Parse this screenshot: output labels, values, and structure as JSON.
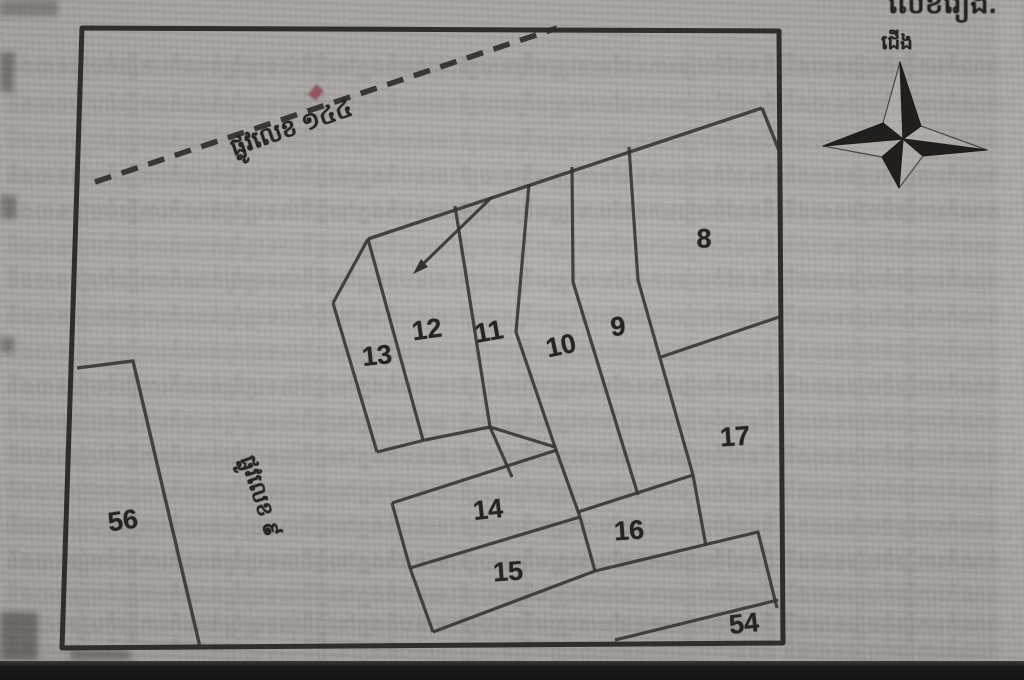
{
  "figure": {
    "description_labels": {
      "corner_fragment": "លេខរៀង.",
      "north": "ជើង"
    },
    "colors": {
      "paper": "#a9a6a2",
      "ink": "#2f2e2a",
      "interior_line": "#35322d",
      "label_ink": "#26241f",
      "bleed_default": "#6e6a64",
      "bleed_warm": "#7a6055",
      "photo_band": "#191917",
      "artifact_red": "#8c3e4e"
    }
  },
  "roads": [
    {
      "name": "road-144",
      "label": "ផ្លូវលេខ ១៤៤",
      "x": 292,
      "y": 130,
      "rotation": -19
    },
    {
      "name": "road-9",
      "label": "ផ្លូវលេខ ៩",
      "x": 258,
      "y": 497,
      "rotation": 72
    }
  ],
  "compass": {
    "label": "ជើង",
    "label_x": 897,
    "label_y": 44,
    "center": [
      903,
      139
    ]
  },
  "parcels": [
    {
      "number": "8",
      "x": 704,
      "y": 239,
      "rotation": 0
    },
    {
      "number": "9",
      "x": 618,
      "y": 327,
      "rotation": -5
    },
    {
      "number": "10",
      "x": 561,
      "y": 346,
      "rotation": -12
    },
    {
      "number": "11",
      "x": 489,
      "y": 332,
      "rotation": -10
    },
    {
      "number": "12",
      "x": 427,
      "y": 330,
      "rotation": -8
    },
    {
      "number": "13",
      "x": 377,
      "y": 356,
      "rotation": -6
    },
    {
      "number": "14",
      "x": 488,
      "y": 510,
      "rotation": -6
    },
    {
      "number": "15",
      "x": 508,
      "y": 572,
      "rotation": -4
    },
    {
      "number": "16",
      "x": 629,
      "y": 531,
      "rotation": -4
    },
    {
      "number": "17",
      "x": 735,
      "y": 437,
      "rotation": -4
    },
    {
      "number": "54",
      "x": 744,
      "y": 624,
      "rotation": -6
    },
    {
      "number": "56",
      "x": 123,
      "y": 521,
      "rotation": -8
    }
  ],
  "geometry": {
    "border": [
      [
        82,
        28
      ],
      [
        779,
        31
      ],
      [
        783,
        643
      ],
      [
        62,
        648
      ]
    ],
    "dashed_road": [
      [
        95,
        182
      ],
      [
        557,
        28
      ]
    ],
    "lines": [
      {
        "name": "parcel56-boundary",
        "w": 3.4,
        "pts": [
          [
            77,
            368
          ],
          [
            133,
            361
          ],
          [
            200,
            647
          ]
        ]
      },
      {
        "name": "top-diagonal",
        "w": 3.4,
        "pts": [
          [
            368,
            239
          ],
          [
            762,
            108
          ]
        ]
      },
      {
        "name": "apex-right-edge",
        "w": 3.4,
        "pts": [
          [
            762,
            108
          ],
          [
            780,
            153
          ]
        ]
      },
      {
        "name": "p13-left-upper",
        "w": 3.2,
        "pts": [
          [
            368,
            239
          ],
          [
            333,
            303
          ]
        ]
      },
      {
        "name": "p13-left-lower",
        "w": 3.2,
        "pts": [
          [
            333,
            303
          ],
          [
            377,
            452
          ]
        ]
      },
      {
        "name": "p13-bottom",
        "w": 3.2,
        "pts": [
          [
            377,
            452
          ],
          [
            425,
            440
          ]
        ]
      },
      {
        "name": "b13-12",
        "w": 3.2,
        "pts": [
          [
            368,
            239
          ],
          [
            423,
            440
          ]
        ]
      },
      {
        "name": "b12-11",
        "w": 3.2,
        "pts": [
          [
            455,
            206
          ],
          [
            490,
            427
          ],
          [
            512,
            477
          ]
        ]
      },
      {
        "name": "p12-bottom",
        "w": 3.2,
        "pts": [
          [
            425,
            440
          ],
          [
            490,
            427
          ]
        ]
      },
      {
        "name": "b11-10",
        "w": 3.2,
        "pts": [
          [
            529,
            184
          ],
          [
            516,
            332
          ],
          [
            555,
            447
          ],
          [
            580,
            517
          ],
          [
            595,
            571
          ]
        ]
      },
      {
        "name": "p11-bottom",
        "w": 3.2,
        "pts": [
          [
            490,
            427
          ],
          [
            555,
            447
          ]
        ]
      },
      {
        "name": "p14-top",
        "w": 3.2,
        "pts": [
          [
            392,
            503
          ],
          [
            557,
            450
          ]
        ]
      },
      {
        "name": "p14-15-left",
        "w": 3.2,
        "pts": [
          [
            392,
            503
          ],
          [
            410,
            568
          ],
          [
            433,
            632
          ]
        ]
      },
      {
        "name": "b14-15",
        "w": 3.2,
        "pts": [
          [
            410,
            568
          ],
          [
            580,
            517
          ]
        ]
      },
      {
        "name": "p15-bottom",
        "w": 3.2,
        "pts": [
          [
            433,
            632
          ],
          [
            595,
            571
          ]
        ]
      },
      {
        "name": "b10-9",
        "w": 3.2,
        "pts": [
          [
            572,
            167
          ],
          [
            573,
            282
          ],
          [
            638,
            495
          ]
        ]
      },
      {
        "name": "b9-right",
        "w": 3.2,
        "pts": [
          [
            629,
            147
          ],
          [
            638,
            280
          ],
          [
            693,
            475
          ]
        ]
      },
      {
        "name": "p16-top",
        "w": 3.2,
        "pts": [
          [
            578,
            512
          ],
          [
            693,
            475
          ]
        ]
      },
      {
        "name": "p16-right",
        "w": 3.2,
        "pts": [
          [
            693,
            475
          ],
          [
            706,
            546
          ]
        ]
      },
      {
        "name": "b8-17",
        "w": 3.2,
        "pts": [
          [
            661,
            357
          ],
          [
            779,
            317
          ]
        ]
      },
      {
        "name": "b17-54-upper",
        "w": 3.2,
        "pts": [
          [
            595,
            571
          ],
          [
            758,
            532
          ],
          [
            777,
            608
          ]
        ]
      },
      {
        "name": "p54-top",
        "w": 3.2,
        "pts": [
          [
            615,
            640
          ],
          [
            778,
            600
          ]
        ]
      }
    ],
    "arrow": {
      "shaft": [
        [
          492,
          197
        ],
        [
          423,
          264
        ]
      ],
      "head": [
        [
          413,
          274
        ],
        [
          421,
          259
        ],
        [
          428,
          267
        ]
      ]
    },
    "compass": {
      "dark": [
        [
          [
            900,
            62
          ],
          [
            921,
            126
          ],
          [
            903,
            139
          ]
        ],
        [
          [
            987,
            150
          ],
          [
            923,
            156
          ],
          [
            903,
            139
          ]
        ],
        [
          [
            899,
            188
          ],
          [
            882,
            157
          ],
          [
            903,
            139
          ]
        ],
        [
          [
            823,
            146
          ],
          [
            883,
            123
          ],
          [
            903,
            139
          ]
        ]
      ],
      "light": [
        [
          [
            900,
            62
          ],
          [
            883,
            123
          ],
          [
            903,
            139
          ]
        ],
        [
          [
            987,
            150
          ],
          [
            921,
            126
          ],
          [
            903,
            139
          ]
        ],
        [
          [
            899,
            188
          ],
          [
            923,
            156
          ],
          [
            903,
            139
          ]
        ],
        [
          [
            823,
            146
          ],
          [
            882,
            157
          ],
          [
            903,
            139
          ]
        ]
      ]
    }
  },
  "bleed": {
    "sample": "នឹងបានរៀបចំធ្វើការកំណត់ព្រំប្រទល់ដីធ្លីនៅក្នុងតំបន់នេះឱ្យបានត្រឹមត្រូវតាមផែនការរៀបចំដែនដី ",
    "rows": [
      {
        "y": 54,
        "opacity": 0.26,
        "color": "#6e6a64"
      },
      {
        "y": 92,
        "opacity": 0.2,
        "color": "#6e6a64"
      },
      {
        "y": 128,
        "opacity": 0.17,
        "color": "#6e6a64"
      },
      {
        "y": 164,
        "opacity": 0.24,
        "color": "#6e6a64"
      },
      {
        "y": 199,
        "opacity": 0.3,
        "color": "#6e6a64"
      },
      {
        "y": 234,
        "opacity": 0.18,
        "color": "#6e6a64"
      },
      {
        "y": 268,
        "opacity": 0.26,
        "color": "#6e6a64"
      },
      {
        "y": 304,
        "opacity": 0.22,
        "color": "#6e6a64"
      },
      {
        "y": 339,
        "opacity": 0.19,
        "color": "#6e6a64"
      },
      {
        "y": 374,
        "opacity": 0.26,
        "color": "#6e6a64"
      },
      {
        "y": 409,
        "opacity": 0.21,
        "color": "#6e6a64"
      },
      {
        "y": 444,
        "opacity": 0.24,
        "color": "#6e6a64"
      },
      {
        "y": 479,
        "opacity": 0.19,
        "color": "#6e6a64"
      },
      {
        "y": 514,
        "opacity": 0.23,
        "color": "#6e6a64"
      },
      {
        "y": 549,
        "opacity": 0.27,
        "color": "#7a6055"
      },
      {
        "y": 582,
        "opacity": 0.21,
        "color": "#7a6055"
      },
      {
        "y": 612,
        "opacity": 0.25,
        "color": "#7a6055"
      },
      {
        "y": 638,
        "opacity": 0.2,
        "color": "#7a6055"
      }
    ]
  }
}
